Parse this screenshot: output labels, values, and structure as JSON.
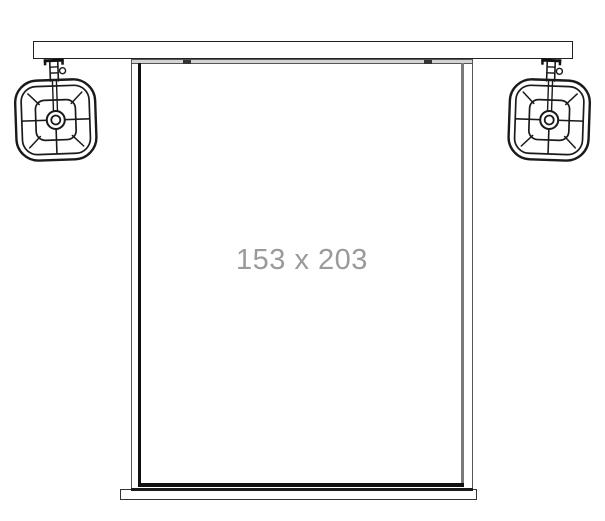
{
  "screen": {
    "size_label": "153 x 203"
  },
  "components": {
    "mount_bar_icon": "ceiling-mount-bar",
    "speaker_left_icon": "hanging-speaker-left",
    "speaker_right_icon": "hanging-speaker-right",
    "screen_icon": "projection-screen",
    "bottom_bar_icon": "screen-weight-bar"
  },
  "colors": {
    "line": "#1a1a1a",
    "frame_gray": "#7a7a7a",
    "casing_gray": "#d4d4d4",
    "label_gray": "#9a9a9a",
    "background": "#ffffff"
  }
}
